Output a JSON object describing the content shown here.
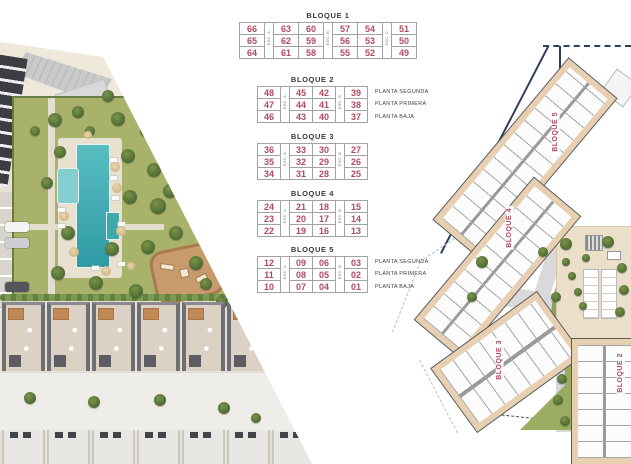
{
  "legend_tables": {
    "bloques": [
      {
        "title": "BLOQUE 1",
        "pattern": [
          "n",
          "e",
          "n",
          "n",
          "e",
          "n",
          "n",
          "e",
          "n"
        ],
        "esc_labels": [
          "ESC. A",
          "ESC. B",
          "ESC. C"
        ],
        "rows": [
          [
            "66",
            "63",
            "60",
            "57",
            "54",
            "51"
          ],
          [
            "65",
            "62",
            "59",
            "56",
            "53",
            "50"
          ],
          [
            "64",
            "61",
            "58",
            "55",
            "52",
            "49"
          ]
        ],
        "planta_labels": []
      },
      {
        "title": "BLOQUE 2",
        "pattern": [
          "n",
          "e",
          "n",
          "n",
          "e",
          "n"
        ],
        "esc_labels": [
          "ESC. A",
          "ESC. B"
        ],
        "rows": [
          [
            "48",
            "45",
            "42",
            "39"
          ],
          [
            "47",
            "44",
            "41",
            "38"
          ],
          [
            "46",
            "43",
            "40",
            "37"
          ]
        ],
        "planta_labels": [
          "PLANTA SEGUNDA",
          "PLANTA PRIMERA",
          "PLANTA BAJA"
        ]
      },
      {
        "title": "BLOQUE 3",
        "pattern": [
          "n",
          "e",
          "n",
          "n",
          "e",
          "n"
        ],
        "esc_labels": [
          "ESC. A",
          "ESC. B"
        ],
        "rows": [
          [
            "36",
            "33",
            "30",
            "27"
          ],
          [
            "35",
            "32",
            "29",
            "26"
          ],
          [
            "34",
            "31",
            "28",
            "25"
          ]
        ],
        "planta_labels": []
      },
      {
        "title": "BLOQUE 4",
        "pattern": [
          "n",
          "e",
          "n",
          "n",
          "e",
          "n"
        ],
        "esc_labels": [
          "ESC. A",
          "ESC. B"
        ],
        "rows": [
          [
            "24",
            "21",
            "18",
            "15"
          ],
          [
            "23",
            "20",
            "17",
            "14"
          ],
          [
            "22",
            "19",
            "16",
            "13"
          ]
        ],
        "planta_labels": []
      },
      {
        "title": "BLOQUE 5",
        "pattern": [
          "n",
          "e",
          "n",
          "n",
          "e",
          "n"
        ],
        "esc_labels": [
          "ESC. A",
          "ESC. B"
        ],
        "rows": [
          [
            "12",
            "09",
            "06",
            "03"
          ],
          [
            "11",
            "08",
            "05",
            "02"
          ],
          [
            "10",
            "07",
            "04",
            "01"
          ]
        ],
        "planta_labels": [
          "PLANTA SEGUNDA",
          "PLANTA PRIMERA",
          "PLANTA BAJA"
        ]
      }
    ]
  },
  "site_plan": {
    "block_labels": [
      "BLOQUE 5",
      "BLOQUE 4",
      "BLOQUE 3",
      "BLOQUE 2"
    ]
  },
  "colors": {
    "unit_number": "#b04a5e",
    "table_border": "#a3a3a3",
    "title_text": "#3a3a3a",
    "plan_label": "#b04a5e",
    "boundary_navy": "#2e3f5c",
    "pool": "#4ab2b6",
    "lawn": "#a9b26a",
    "building_apron": "#e7cfb2"
  }
}
